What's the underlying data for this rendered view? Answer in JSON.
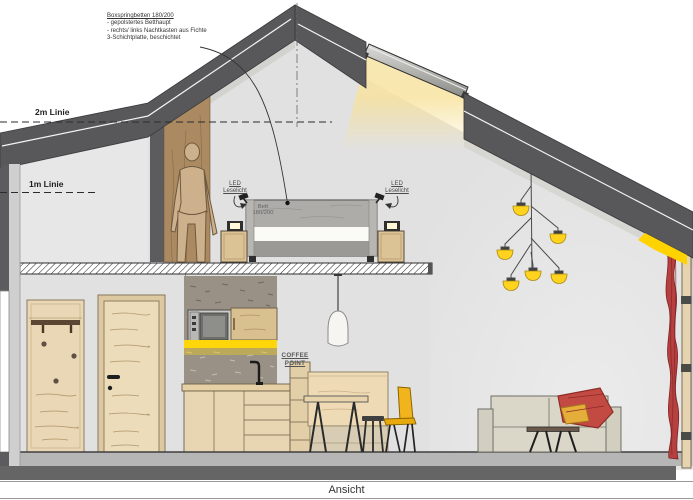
{
  "drawing": {
    "title": "Ansicht",
    "annotation_note": {
      "title": "Boxspringbetten 180/200",
      "line1": "- gepolstertes Betthaupt",
      "line2": "- rechts/ links Nachtkasten aus Fichte",
      "line3": "3-Schichtplatte, beschichtet"
    },
    "height_lines": {
      "line_2m": "2m Linie",
      "line_1m": "1m Linie"
    },
    "led_label_left": {
      "line1": "LED",
      "line2": "Leselicht"
    },
    "led_label_right": {
      "line1": "LED",
      "line2": "Leselicht"
    },
    "bed_label": {
      "line1": "Bett",
      "line2": "180/200"
    },
    "coffee_point": {
      "line1": "COFFEE",
      "line2": "POINT"
    }
  },
  "colors": {
    "roof_grey": "#58585a",
    "interior_wall": "#e1e1e1",
    "wood_light": "#e9d7b5",
    "wood_mid": "#ab8a62",
    "concrete": "#9a9186",
    "accent_yellow": "#ffd60a",
    "glow_yellow": "#f7e19a",
    "curtain_red": "#b64040",
    "sofa_beige": "#dbd7c8",
    "floor_slab": "#b6b6b6",
    "foundation": "#656565",
    "bed_grey": "#b3b1ae"
  }
}
